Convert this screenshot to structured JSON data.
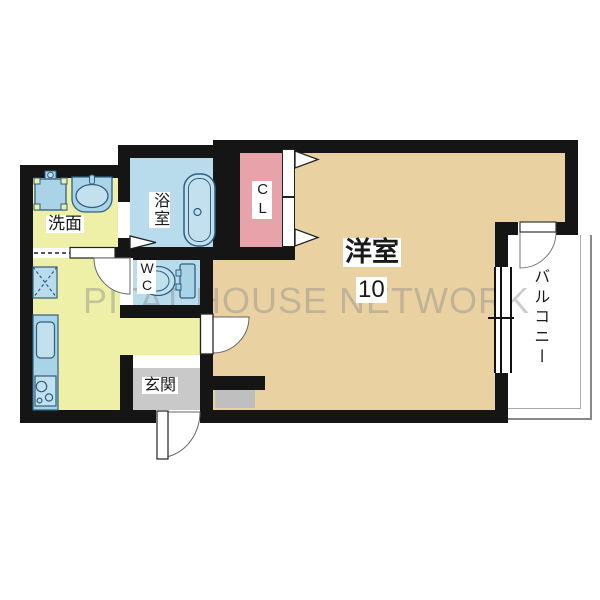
{
  "watermark": {
    "text": "PITAT HOUSE NETWORK"
  },
  "rooms": {
    "main": {
      "name": "洋室",
      "size": "10"
    },
    "balcony": {
      "name": "バルコニー"
    },
    "washroom": {
      "name": "洗面"
    },
    "bathroom": {
      "name": "浴室"
    },
    "toilet": {
      "name": "WC"
    },
    "closet": {
      "name": "CL"
    },
    "entrance": {
      "name": "玄関"
    }
  },
  "colors": {
    "wall": "#151515",
    "room_main": "#ead1a2",
    "room_wet": "#edf0a6",
    "room_bath": "#b9dcec",
    "room_cl": "#e8a2aa",
    "room_genkan": "#c9c9c9",
    "shoe_cabinet": "#bfbfbf",
    "fixture_fill": "#a9d4e7",
    "fixture_light": "#c3e0ef",
    "fixture_stroke": "#2e5f80",
    "watermark": "#8a8a8a",
    "rail": "#888888"
  }
}
